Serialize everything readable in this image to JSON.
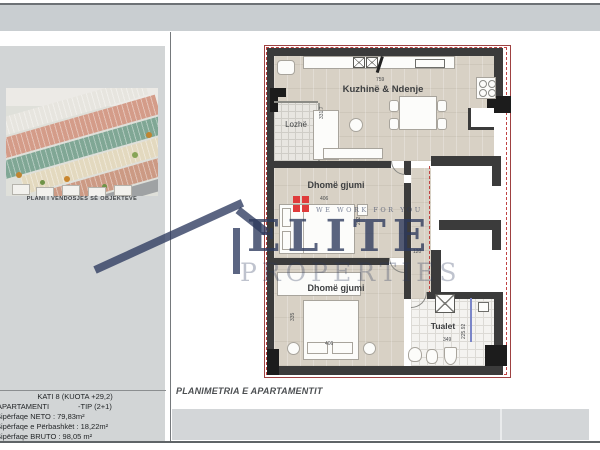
{
  "left_panel": {
    "image_caption": "PLANI I VENDOSJES SË OBJEKTEVE",
    "title_block": {
      "floor_line": "KATI 8 (KUOTA +29,2)",
      "apartment_label": "APARTAMENTI",
      "apartment_type": "-TIP (2+1)",
      "net_area": "Sipërfaqe NETO : 79,83m²",
      "shared_area": "Sipërfaqe e Përbashkët : 18,22m²",
      "gross_area": "Sipërfaqe BRUTO : 98,05 m²"
    }
  },
  "plan": {
    "footer_title": "PLANIMETRIA E APARTAMENTIT",
    "rooms": {
      "kitchen_living": "Kuzhinë & Ndenje",
      "loggia": "Lozhë",
      "bedroom1": "Dhomë gjumi",
      "bedroom2": "Dhomë gjumi",
      "toilet": "Tualet"
    },
    "dimensions": {
      "kitchen_width": "759",
      "loggia_height": "331.7",
      "bedroom1_width": "406",
      "bedroom1_depth": "202",
      "hall_width": "120",
      "bedroom2_height": "335",
      "bedroom2_width": "406",
      "toilet_width": "349",
      "toilet_height": "225.92"
    }
  },
  "watermark": {
    "brand": "ELITE",
    "brand_sub": "PROPERTIES",
    "tagline": "WE WORK FOR YOU"
  }
}
